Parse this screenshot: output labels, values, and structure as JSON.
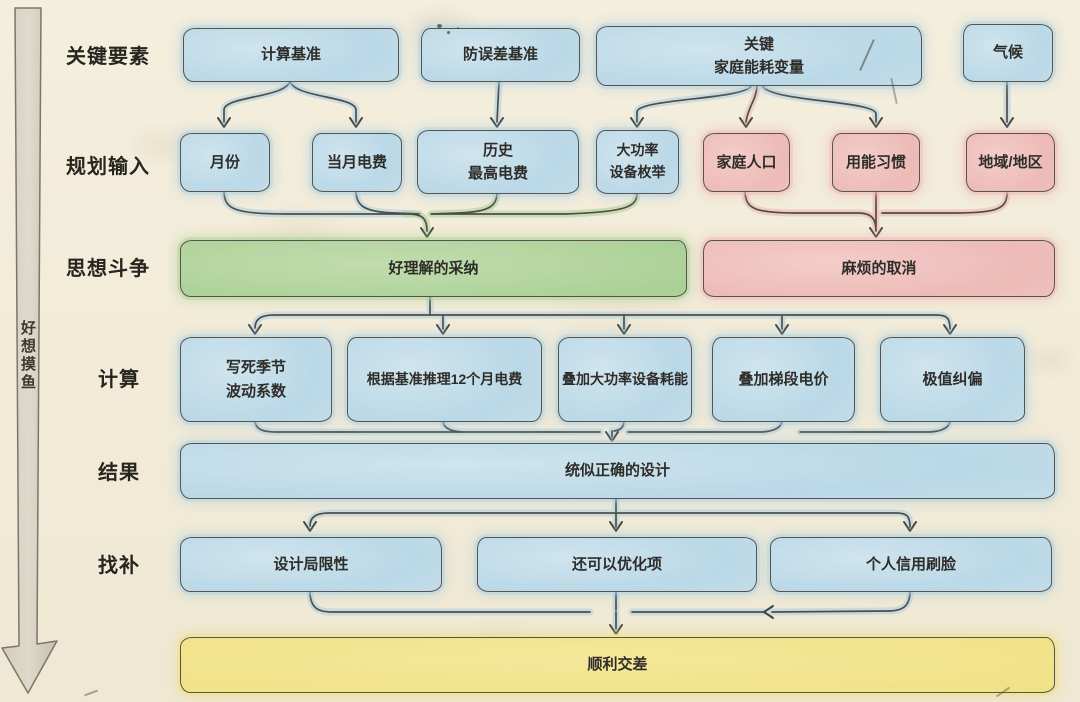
{
  "palette": {
    "paper": "#f3eddc",
    "ink": "#4f4d45",
    "node_blue": "#bad8e7",
    "node_pink": "#edbab6",
    "node_green": "#aad096",
    "node_yellow": "#f0e184",
    "glow_blue": "#a9cfe3",
    "glow_green": "#abd096",
    "glow_pink": "#eebab5"
  },
  "side_note": {
    "text": "好想摸鱼"
  },
  "stages": [
    {
      "label": "关键要素",
      "nodes": [
        {
          "text": "计算基准"
        },
        {
          "text": "防误差基准"
        },
        {
          "text": "关键\n家庭能耗变量"
        },
        {
          "text": "气候"
        }
      ]
    },
    {
      "label": "规划输入",
      "nodes": [
        {
          "text": "月份"
        },
        {
          "text": "当月电费"
        },
        {
          "text": "历史\n最高电费"
        },
        {
          "text": "大功率\n设备枚举"
        },
        {
          "text": "家庭人口"
        },
        {
          "text": "用能习惯"
        },
        {
          "text": "地域/地区"
        }
      ]
    },
    {
      "label": "思想斗争",
      "nodes": [
        {
          "text": "好理解的采纳"
        },
        {
          "text": "麻烦的取消"
        }
      ]
    },
    {
      "label": "计算",
      "nodes": [
        {
          "text": "写死季节\n波动系数"
        },
        {
          "text": "根据基准推理12个月电费"
        },
        {
          "text": "叠加大功率设备耗能"
        },
        {
          "text": "叠加梯段电价"
        },
        {
          "text": "极值纠偏"
        }
      ]
    },
    {
      "label": "结果",
      "nodes": [
        {
          "text": "统似正确的设计"
        }
      ]
    },
    {
      "label": "找补",
      "nodes": [
        {
          "text": "设计局限性"
        },
        {
          "text": "还可以优化项"
        },
        {
          "text": "个人信用刷脸"
        }
      ]
    },
    {
      "label": "",
      "nodes": [
        {
          "text": "顺利交差"
        }
      ]
    }
  ]
}
